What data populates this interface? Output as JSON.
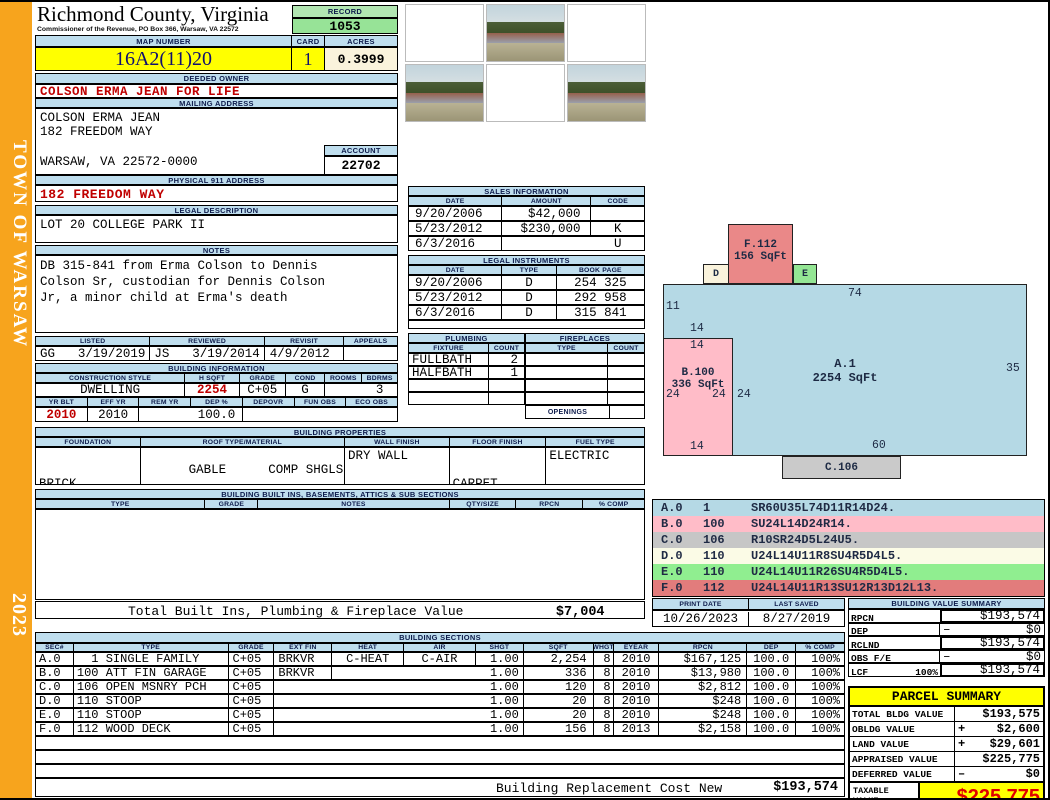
{
  "sidebar": {
    "town": "TOWN OF WARSAW",
    "year": "2023"
  },
  "header": {
    "county": "Richmond County, Virginia",
    "commissioner": "Commissioner of the Revenue, PO Box 366, Warsaw, VA 22572",
    "record_label": "RECORD",
    "record_value": "1053",
    "map_number_label": "MAP NUMBER",
    "map_number_value": "16A2(11)20",
    "card_label": "CARD",
    "card_value": "1",
    "acres_label": "ACRES",
    "acres_value": "0.3999"
  },
  "owner": {
    "deeded_owner_label": "DEEDED OWNER",
    "deeded_owner": "COLSON ERMA JEAN FOR LIFE",
    "mailing_address_label": "MAILING ADDRESS",
    "mailing_line1": "COLSON ERMA JEAN",
    "mailing_line2": "182 FREEDOM WAY",
    "mailing_line3": "WARSAW, VA 22572-0000",
    "account_label": "ACCOUNT",
    "account_value": "22702",
    "physical_address_label": "PHYSICAL 911 ADDRESS",
    "physical_address": "182 FREEDOM WAY",
    "legal_description_label": "LEGAL DESCRIPTION",
    "legal_description": "LOT 20 COLLEGE PARK II",
    "notes_label": "NOTES",
    "notes_line1": "DB 315-841 from Erma Colson to Dennis",
    "notes_line2": "Colson Sr, custodian for Dennis Colson",
    "notes_line3": "Jr, a minor child at Erma's death"
  },
  "visits": {
    "listed_label": "LISTED",
    "reviewed_label": "REVIEWED",
    "revisit_label": "REVISIT",
    "appeals_label": "APPEALS",
    "listed_by": "GG",
    "listed_date": "3/19/2019",
    "reviewed_by": "JS",
    "reviewed_date": "3/19/2014",
    "revisit_date": "4/9/2012",
    "appeals_value": ""
  },
  "building_information": {
    "title": "BUILDING INFORMATION",
    "headers1": [
      "CONSTRUCTION STYLE",
      "H SQFT",
      "GRADE",
      "COND",
      "ROOMS",
      "BDRMS"
    ],
    "values1": [
      "DWELLING",
      "2254",
      "C+05",
      "G",
      "",
      "3"
    ],
    "headers2": [
      "YR BLT",
      "EFF YR",
      "REM YR",
      "DEP %",
      "DEPOVR",
      "FUN OBS",
      "ECO OBS"
    ],
    "values2": [
      "2010",
      "2010",
      "",
      "100.0",
      "",
      "",
      ""
    ]
  },
  "building_properties": {
    "title": "BUILDING PROPERTIES",
    "headers": [
      "FOUNDATION",
      "ROOF TYPE/MATERIAL",
      "WALL FINISH",
      "FLOOR FINISH",
      "FUEL TYPE"
    ],
    "foundation_line1": "BRICK",
    "foundation_line2": "CRAWL",
    "roof_type": "GABLE",
    "roof_material": "COMP SHGLS",
    "wall_finish": "DRY WALL",
    "floor_line1": "CARPET",
    "floor_line2": "VINYL",
    "fuel_type": "ELECTRIC"
  },
  "built_ins": {
    "title": "BUILDING BUILT INS, BASEMENTS, ATTICS & SUB SECTIONS",
    "headers": [
      "TYPE",
      "GRADE",
      "NOTES",
      "QTY/SIZE",
      "RPCN",
      "% COMP"
    ],
    "total_label": "Total Built Ins, Plumbing & Fireplace Value",
    "total_value": "$7,004"
  },
  "sales_information": {
    "title": "SALES INFORMATION",
    "headers": [
      "DATE",
      "AMOUNT",
      "CODE"
    ],
    "rows": [
      [
        "9/20/2006",
        "$42,000",
        ""
      ],
      [
        "5/23/2012",
        "$230,000",
        "K"
      ],
      [
        "6/3/2016",
        "",
        "U"
      ]
    ]
  },
  "legal_instruments": {
    "title": "LEGAL INSTRUMENTS",
    "headers": [
      "DATE",
      "TYPE",
      "BOOK PAGE"
    ],
    "rows": [
      [
        "9/20/2006",
        "D",
        "254 325"
      ],
      [
        "5/23/2012",
        "D",
        "292 958"
      ],
      [
        "6/3/2016",
        "D",
        "315 841"
      ]
    ]
  },
  "plumbing": {
    "title": "PLUMBING",
    "headers": [
      "FIXTURE",
      "COUNT"
    ],
    "rows": [
      [
        "FULLBATH",
        "2"
      ],
      [
        "HALFBATH",
        "1"
      ],
      [
        "",
        ""
      ],
      [
        "",
        ""
      ]
    ]
  },
  "fireplaces": {
    "title": "FIREPLACES",
    "headers": [
      "TYPE",
      "COUNT"
    ],
    "rows": [
      [
        "",
        ""
      ],
      [
        "",
        ""
      ],
      [
        "",
        ""
      ],
      [
        "",
        ""
      ]
    ],
    "openings_label": "OPENINGS",
    "openings_value": ""
  },
  "sketch": {
    "boxes": {
      "f": {
        "label": "F.112",
        "sqft": "156 SqFt"
      },
      "d": {
        "label": "D"
      },
      "e": {
        "label": "E"
      },
      "a": {
        "label": "A.1",
        "sqft": "2254 SqFt"
      },
      "b": {
        "label": "B.100",
        "sqft": "336 SqFt"
      },
      "c": {
        "label": "C.106"
      }
    },
    "dims": {
      "a_top": "74",
      "a_left_upper": "11",
      "b_above": "14",
      "b_top": "14",
      "a_right": "35",
      "b_left": "24",
      "b_right": "24",
      "a_inner_left": "24",
      "b_bottom": "14",
      "a_bottom": "60"
    },
    "codes": [
      {
        "sec": "A.0",
        "num": "1",
        "path": "SR60U35L74D11R14D24."
      },
      {
        "sec": "B.0",
        "num": "100",
        "path": "SU24L14D24R14."
      },
      {
        "sec": "C.0",
        "num": "106",
        "path": "R10SR24D5L24U5."
      },
      {
        "sec": "D.0",
        "num": "110",
        "path": "U24L14U11R8SU4R5D4L5."
      },
      {
        "sec": "E.0",
        "num": "110",
        "path": "U24L14U11R26SU4R5D4L5."
      },
      {
        "sec": "F.0",
        "num": "112",
        "path": "U24L14U11R13SU12R13D12L13."
      }
    ]
  },
  "print_info": {
    "print_date_label": "PRINT DATE",
    "print_date": "10/26/2023",
    "last_saved_label": "LAST SAVED",
    "last_saved": "8/27/2019"
  },
  "building_value_summary": {
    "title": "BUILDING VALUE SUMMARY",
    "rows": [
      {
        "label": "RPCN",
        "extra": "",
        "op": "",
        "value": "$193,574"
      },
      {
        "label": "DEP",
        "extra": "",
        "op": "–",
        "value": "$0"
      },
      {
        "label": "RCLND",
        "extra": "",
        "op": "",
        "value": "$193,574"
      },
      {
        "label": "OBS F/E",
        "extra": "",
        "op": "–",
        "value": "$0"
      },
      {
        "label": "LCF",
        "extra": "100%",
        "op": "",
        "value": "$193,574"
      }
    ]
  },
  "parcel_summary": {
    "title": "PARCEL SUMMARY",
    "rows": [
      {
        "label": "TOTAL BLDG VALUE",
        "op": "",
        "value": "$193,575"
      },
      {
        "label": "OBLDG VALUE",
        "op": "+",
        "value": "$2,600"
      },
      {
        "label": "LAND VALUE",
        "op": "+",
        "value": "$29,601"
      },
      {
        "label": "APPRAISED VALUE",
        "op": "",
        "value": "$225,775"
      },
      {
        "label": "DEFERRED VALUE",
        "op": "–",
        "value": "$0"
      }
    ],
    "taxable_label_line1": "TAXABLE",
    "taxable_label_line2": "VALUE",
    "taxable_value": "$225,775"
  },
  "building_sections": {
    "title": "BUILDING SECTIONS",
    "headers": [
      "SEC#",
      "TYPE",
      "GRADE",
      "EXT FIN",
      "HEAT",
      "AIR",
      "SHGT",
      "SQFT",
      "WHGT",
      "EYEAR",
      "RPCN",
      "DEP",
      "% COMP"
    ],
    "rows": [
      {
        "sec": "A.0",
        "type": "  1 SINGLE FAMILY",
        "grade": "C+05",
        "ext": "BRKVR",
        "heat": "C-HEAT",
        "air": "C-AIR",
        "shgt": "1.00",
        "sqft": "2,254",
        "whgt": "8",
        "eyear": "2010",
        "rpcn": "$167,125",
        "dep": "100.0",
        "comp": "100%"
      },
      {
        "sec": "B.0",
        "type": "100 ATT FIN GARAGE",
        "grade": "C+05",
        "ext": "BRKVR",
        "heat": "",
        "air": "",
        "shgt": "1.00",
        "sqft": "336",
        "whgt": "8",
        "eyear": "2010",
        "rpcn": "$13,980",
        "dep": "100.0",
        "comp": "100%"
      },
      {
        "sec": "C.0",
        "type": "106 OPEN MSNRY PCH",
        "grade": "C+05",
        "ext": "",
        "heat": "",
        "air": "",
        "shgt": "1.00",
        "sqft": "120",
        "whgt": "8",
        "eyear": "2010",
        "rpcn": "$2,812",
        "dep": "100.0",
        "comp": "100%"
      },
      {
        "sec": "D.0",
        "type": "110 STOOP",
        "grade": "C+05",
        "ext": "",
        "heat": "",
        "air": "",
        "shgt": "1.00",
        "sqft": "20",
        "whgt": "8",
        "eyear": "2010",
        "rpcn": "$248",
        "dep": "100.0",
        "comp": "100%"
      },
      {
        "sec": "E.0",
        "type": "110 STOOP",
        "grade": "C+05",
        "ext": "",
        "heat": "",
        "air": "",
        "shgt": "1.00",
        "sqft": "20",
        "whgt": "8",
        "eyear": "2010",
        "rpcn": "$248",
        "dep": "100.0",
        "comp": "100%"
      },
      {
        "sec": "F.0",
        "type": "112 WOOD DECK",
        "grade": "C+05",
        "ext": "",
        "heat": "",
        "air": "",
        "shgt": "1.00",
        "sqft": "156",
        "whgt": "8",
        "eyear": "2013",
        "rpcn": "$2,158",
        "dep": "100.0",
        "comp": "100%"
      }
    ],
    "replacement_label": "Building Replacement Cost New",
    "replacement_value": "$193,574"
  }
}
